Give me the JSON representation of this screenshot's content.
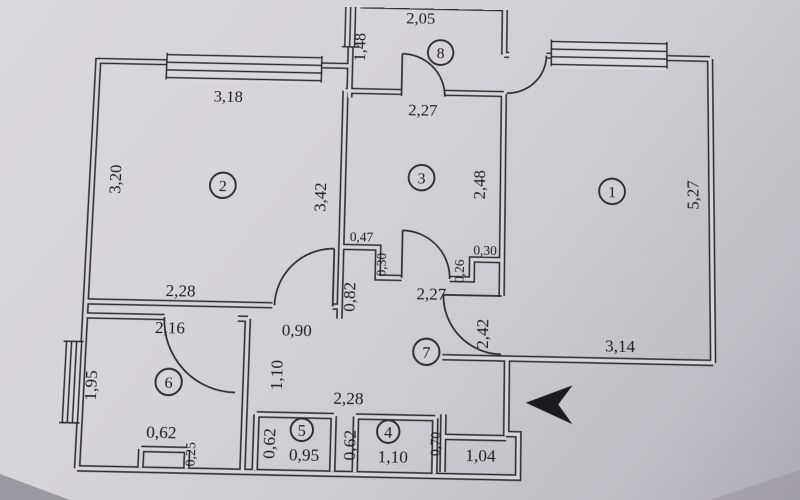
{
  "colors": {
    "paper": "#d6d3d9",
    "ink": "#2c2b2e"
  },
  "icons": {
    "entrance_marker": "left-arrow"
  },
  "room_numbers": {
    "r1": "1",
    "r2": "2",
    "r3": "3",
    "r4": "4",
    "r5": "5",
    "r6": "6",
    "r7": "7",
    "r8": "8"
  },
  "dimensions": {
    "room8_width": "2,05",
    "room8_window": "1,48",
    "room3_width": "2,27",
    "room3_height": "2,48",
    "room2_width": "3,18",
    "room2_height_left": "3,20",
    "room2_height_right": "3,42",
    "room2_width_bottom": "2,28",
    "duct_left_width": "0,47",
    "duct_left_depth": "0,30",
    "duct_right_depth": "0,26",
    "duct_right_width": "0,30",
    "room1_height": "5,27",
    "room1_width": "3,14",
    "hall_width": "2,27",
    "hall_stub": "0,82",
    "room2_door": "0,90",
    "room6_door": "1,10",
    "hall_entry": "2,42",
    "hall_bottom": "2,28",
    "room6_width": "2,16",
    "room6_height": "1,95",
    "room6_niche_width": "0,62",
    "room6_niche_depth": "0,25",
    "room5_depth": "0,62",
    "room5_width": "0,95",
    "room4_depth": "0,62",
    "room4_width": "1,10",
    "vestibule_depth": "0,70",
    "vestibule_width": "1,04"
  }
}
